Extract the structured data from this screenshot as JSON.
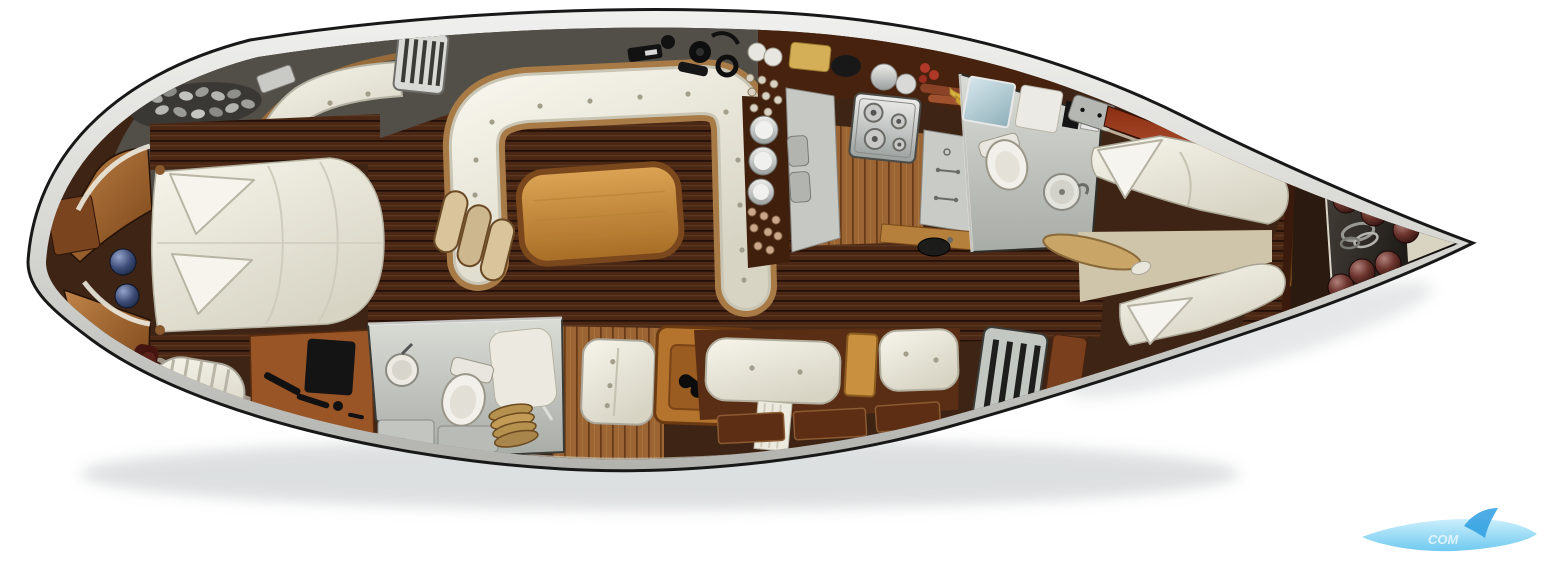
{
  "scene": {
    "type": "yacht-interior-floorplan",
    "view": "top-down",
    "background": "#ffffff"
  },
  "watermark": {
    "text": "COM",
    "swoosh_color": "#7fd0f2",
    "sail_color": "#2e9de0"
  },
  "colors": {
    "hull_outline": "#181818",
    "hull_rim": "#d2d2d0",
    "deck_gray": "#524f48",
    "floor_dark_wood": "#3e2414",
    "plank_line": "#241007",
    "galley_band": "#46220f",
    "galley_wood": "#9a6434",
    "trim_wood": "#a87a46",
    "teak_table": "#c9913f",
    "mahogany": "#7a2812",
    "wardrobe_orange": "#b06a2e",
    "cushion_white": "#eceade",
    "bathroom_gray": "#c9ccc6",
    "counter_gray": "#c6c9c3",
    "steel": "#c9c9c7",
    "stern_dark": "#2a1a10",
    "aft_floor_beige": "#cfc5aa",
    "fender_maroon": "#5a2b28",
    "sphere_navy": "#2b3a5e",
    "food_banana": "#d9b13e",
    "food_sausage": "#8a4226",
    "food_tomato": "#b03828"
  },
  "regions": [
    {
      "id": "bow-anchor-locker",
      "label": "Bow anchor locker"
    },
    {
      "id": "anchor-chain",
      "label": "Anchor chain"
    },
    {
      "id": "bow-v-seat",
      "label": "Bow seat"
    },
    {
      "id": "forward-cabin",
      "label": "Forward double berth cabin"
    },
    {
      "id": "forward-head",
      "label": "Forward bathroom"
    },
    {
      "id": "vanity-desk",
      "label": "Vanity desk"
    },
    {
      "id": "towel-roll",
      "label": "Towel roll"
    },
    {
      "id": "salon",
      "label": "Salon U-settee and teak table"
    },
    {
      "id": "mast-steps",
      "label": "Mast steps"
    },
    {
      "id": "deck-hardware",
      "label": "Deck hardware"
    },
    {
      "id": "galley",
      "label": "Galley with stove and sink"
    },
    {
      "id": "nav-station",
      "label": "Chart table with binoculars"
    },
    {
      "id": "starboard-settee",
      "label": "Starboard settee"
    },
    {
      "id": "companionway-grille",
      "label": "Companionway grille"
    },
    {
      "id": "aft-head",
      "label": "Aft bathroom"
    },
    {
      "id": "aft-cabin",
      "label": "Aft twin berth cabin"
    },
    {
      "id": "stern-fenders",
      "label": "Stern fender storage"
    }
  ]
}
